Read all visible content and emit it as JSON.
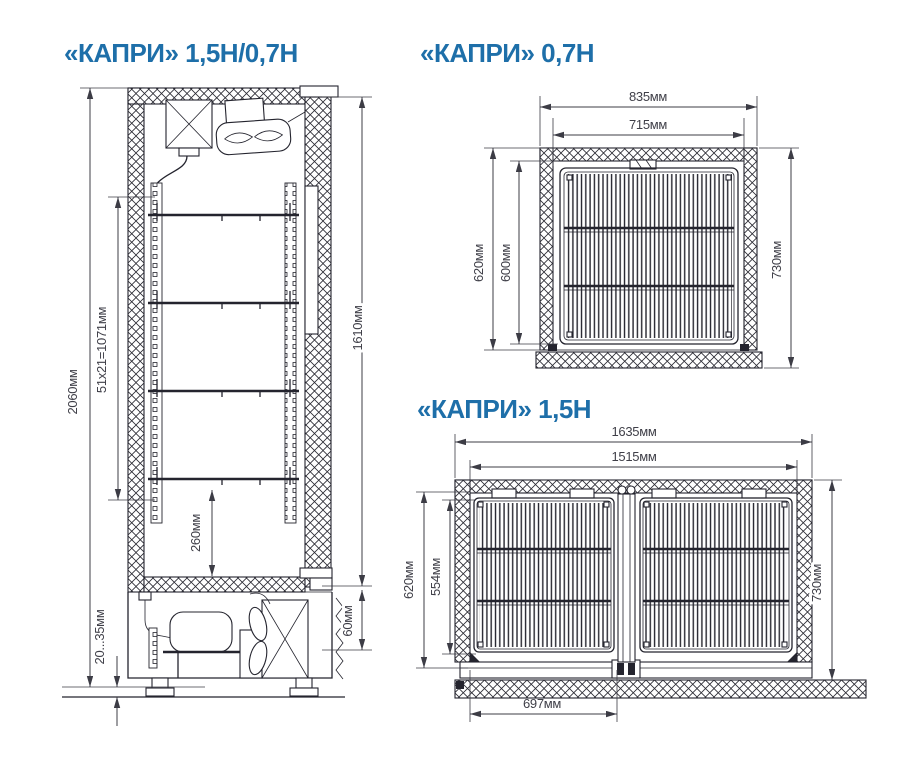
{
  "page": {
    "background": "#ffffff",
    "accent_color": "#1e6fa9",
    "line_color": "#24242e"
  },
  "diagrams": {
    "side_view": {
      "title": "«КАПРИ»  1,5Н/0,7Н",
      "dims": {
        "overall_height": "2060мм",
        "shelf_pitch": "51х21=1071мм",
        "bottom_clearance": "260мм",
        "leg_range": "20...35мм",
        "door_height": "1610мм",
        "plinth_gap": "60мм"
      }
    },
    "view_07": {
      "title": "«КАПРИ»  0,7Н",
      "dims": {
        "outer_width": "835мм",
        "inner_width": "715мм",
        "outer_depth": "620мм",
        "inner_depth": "600мм",
        "overall_depth": "730мм"
      }
    },
    "view_15": {
      "title": "«КАПРИ» 1,5Н",
      "dims": {
        "outer_width": "1635мм",
        "inner_width": "1515мм",
        "outer_depth": "620мм",
        "inner_depth": "554мм",
        "overall_depth": "730мм",
        "door_width": "697мм"
      }
    }
  }
}
